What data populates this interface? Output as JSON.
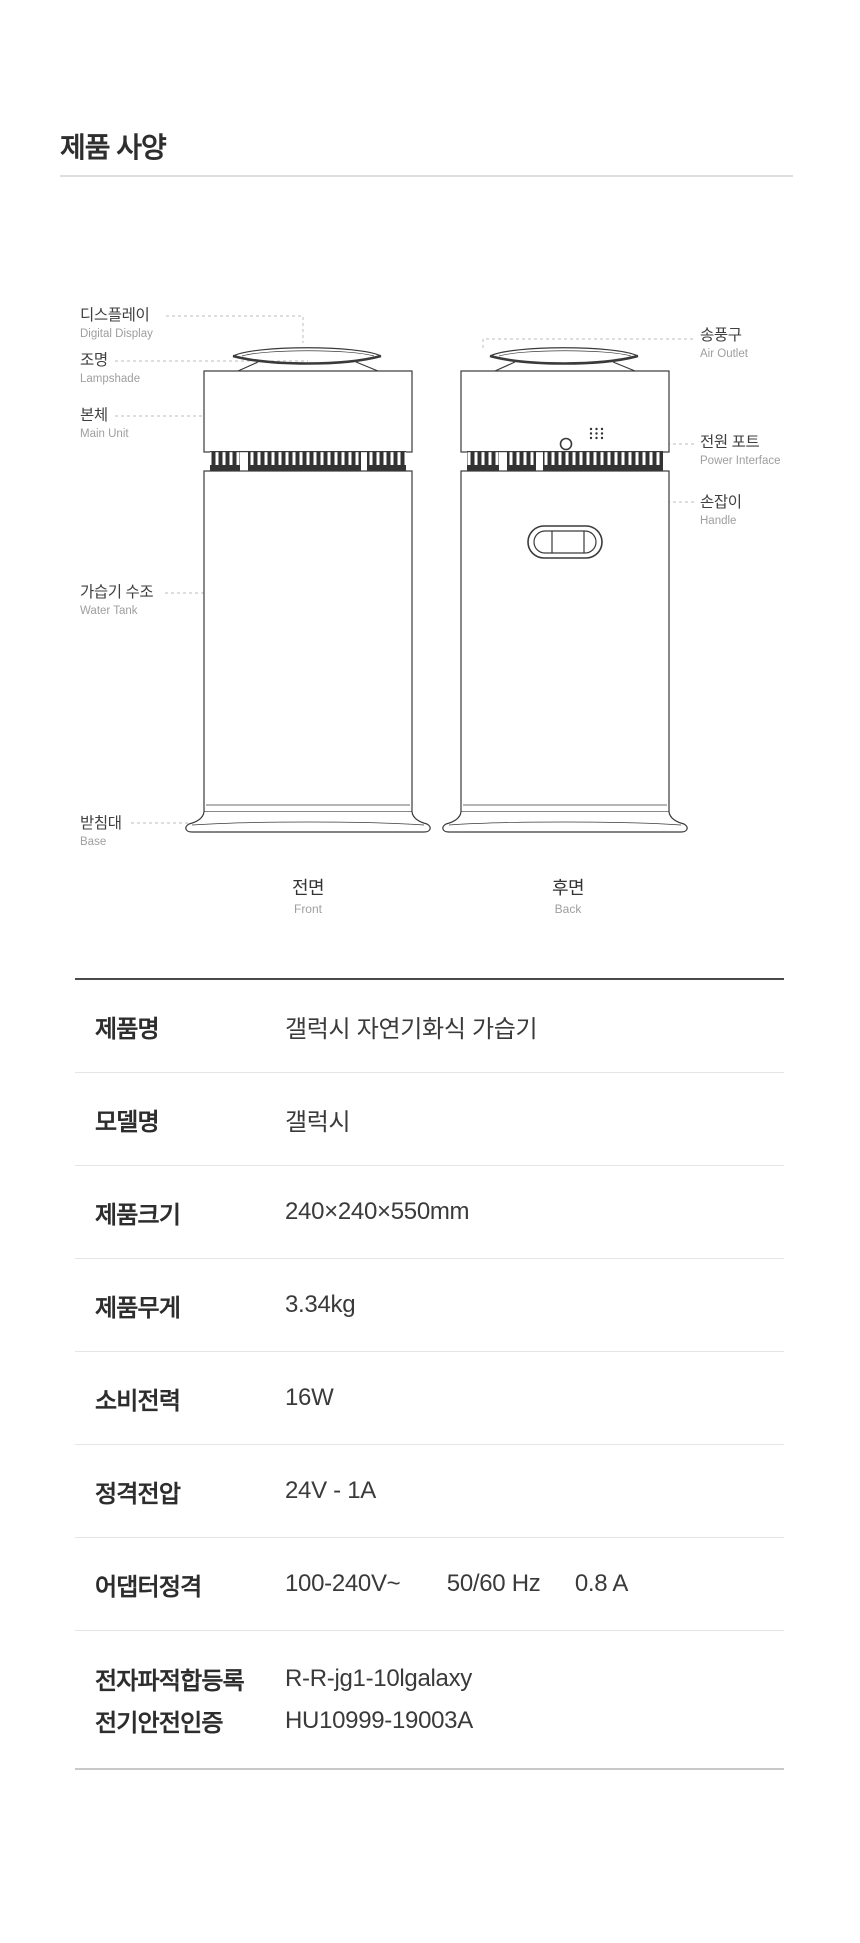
{
  "header": {
    "title": "제품 사양"
  },
  "diagram": {
    "left_labels": [
      {
        "ko": "디스플레이",
        "en": "Digital Display"
      },
      {
        "ko": "조명",
        "en": "Lampshade"
      },
      {
        "ko": "본체",
        "en": "Main Unit"
      },
      {
        "ko": "가습기 수조",
        "en": "Water Tank"
      },
      {
        "ko": "받침대",
        "en": "Base"
      }
    ],
    "right_labels": [
      {
        "ko": "송풍구",
        "en": "Air Outlet"
      },
      {
        "ko": "전원 포트",
        "en": "Power Interface"
      },
      {
        "ko": "손잡이",
        "en": "Handle"
      }
    ],
    "captions": [
      {
        "ko": "전면",
        "en": "Front"
      },
      {
        "ko": "후면",
        "en": "Back"
      }
    ]
  },
  "table": {
    "rows": [
      {
        "label": "제품명",
        "value": "갤럭시 자연기화식 가습기"
      },
      {
        "label": "모델명",
        "value": "갤럭시"
      },
      {
        "label": "제품크기",
        "value": "240×240×550mm"
      },
      {
        "label": "제품무게",
        "value": "3.34kg"
      },
      {
        "label": "소비전력",
        "value": "16W"
      },
      {
        "label": "정격전압",
        "value": "24V - 1A"
      },
      {
        "label": "어댑터정격",
        "value_parts": [
          "100-240V~",
          "50/60 Hz",
          "0.8 A"
        ]
      },
      {
        "lines": [
          {
            "label": "전자파적합등록",
            "value": "R-R-jg1-10lgalaxy"
          },
          {
            "label": "전기안전인증",
            "value": "HU10999-19003A"
          }
        ]
      }
    ]
  },
  "colors": {
    "title_text": "#2e2e2e",
    "diagram_label": "#3f3f3f",
    "diagram_sublabel": "#9e9e9e",
    "outline": "#3a3a3a",
    "leader_line": "#bcbcbc",
    "table_top_border": "#4a4a4a",
    "table_divider": "#e5e5e5",
    "table_bottom_border": "#c9c9c9"
  }
}
